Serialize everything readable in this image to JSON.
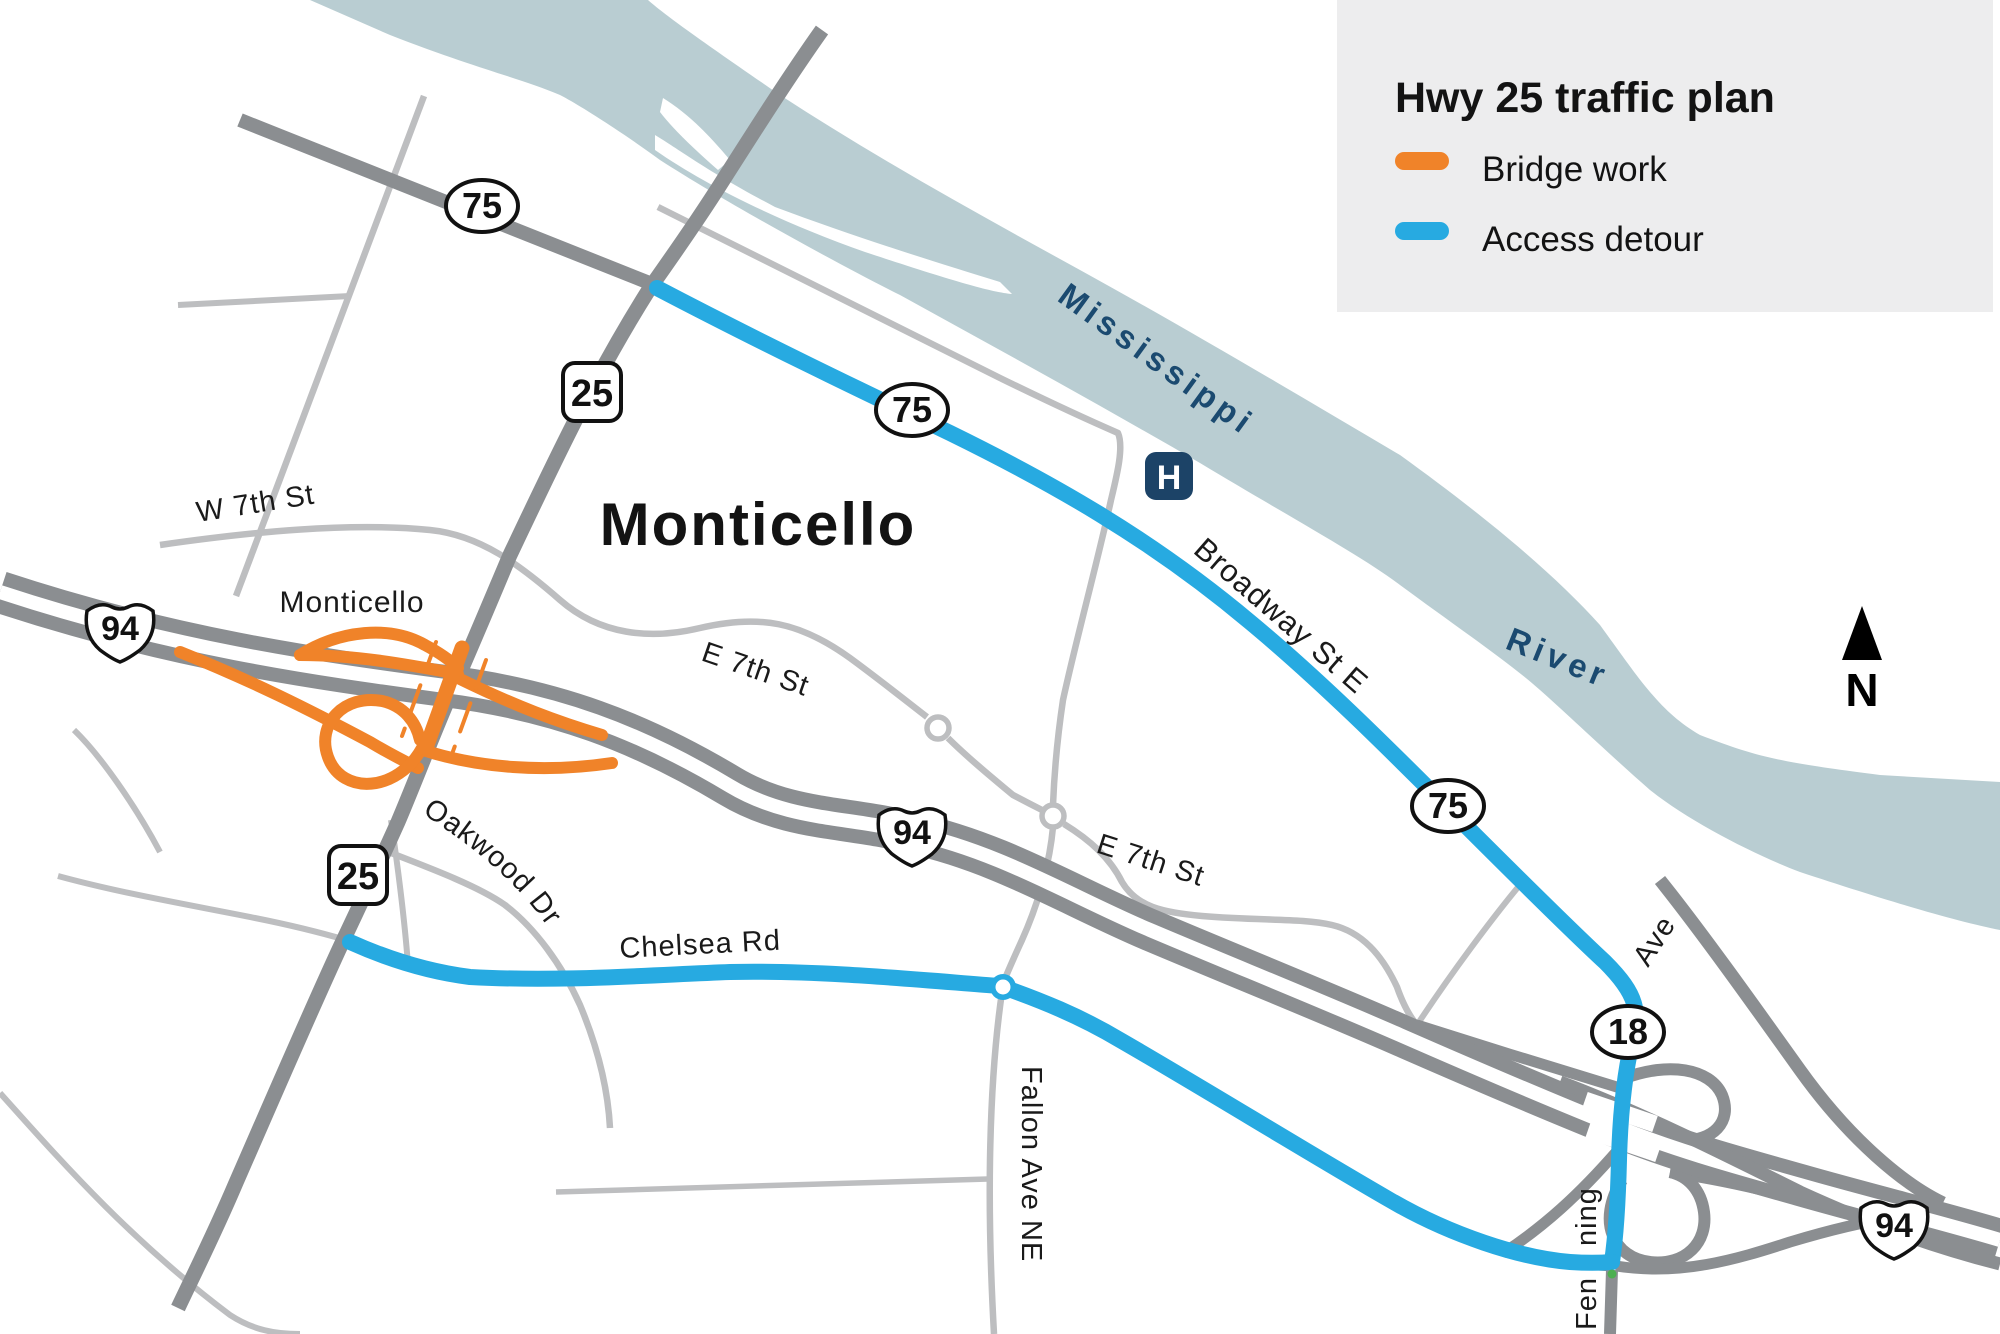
{
  "legend": {
    "title": "Hwy 25 traffic plan",
    "items": [
      {
        "id": "bridge-work",
        "label": "Bridge work",
        "color": "#F08329"
      },
      {
        "id": "access-detour",
        "label": "Access detour",
        "color": "#27AAE1"
      }
    ]
  },
  "labels": {
    "city_large": "Monticello",
    "city_small": "Monticello",
    "w7th": "W 7th St",
    "e7th_a": "E 7th St",
    "e7th_b": "E 7th St",
    "broadway": "Broadway St E",
    "chelsea": "Chelsea Rd",
    "oakwood": "Oakwood  Dr",
    "fallon": "Fallon Ave NE",
    "fenning_bottom": "Fen",
    "fenning_top": "ning",
    "ave": "Ave",
    "river_1": "Mississippi",
    "river_2": "River",
    "north": "N",
    "hospital": "H"
  },
  "shields": {
    "route75": "75",
    "route25": "25",
    "interstate94": "94",
    "route18": "18"
  },
  "colors": {
    "bridge_work": "#F08329",
    "access_detour": "#27AAE1",
    "river": "#B9CDD2",
    "road_major": "#8B8E91",
    "road_minor": "#BDBEC0",
    "water_text": "#1B4A70",
    "hospital_bg": "#1C4367",
    "legend_bg": "#EDEDEE",
    "ink": "#131313"
  }
}
